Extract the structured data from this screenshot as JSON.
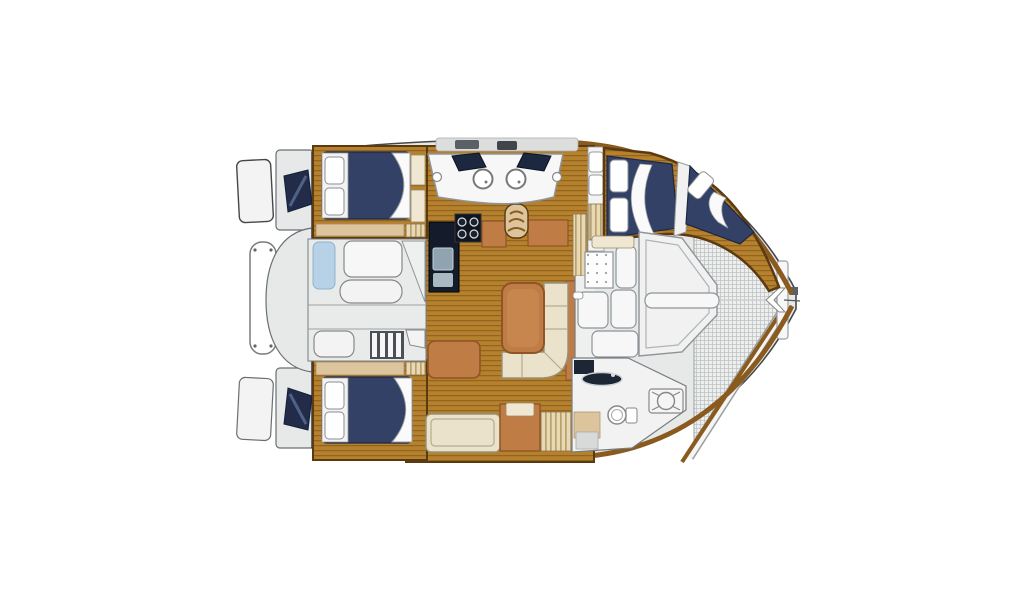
{
  "title": "catamaran-interior-floor-plan",
  "canvas": {
    "width": 1024,
    "height": 600,
    "background": "#ffffff"
  },
  "palette": {
    "hull_fill": "#e7e9e8",
    "hull_stroke": "#43484c",
    "deck_white": "#f2f3f2",
    "panel_white": "#f6f7f6",
    "teak": "#b5812c",
    "teak_grain": "#8a5d1e",
    "wood_trim": "#5b3a10",
    "wood_mid": "#8a5a1e",
    "furniture": "#bf7c45",
    "furniture_dark": "#8f5526",
    "berth_navy": "#334167",
    "berth_navy_dark": "#222c49",
    "pillow_white": "#ffffff",
    "cushion_cream": "#ebe2cc",
    "cushion_edge": "#b6ab8e",
    "pad_blue": "#b7d2e6",
    "counter_black": "#141c2b",
    "tan_shelf": "#dcc49c",
    "stripe_tan": "#e8d9b4",
    "stripe_line": "#a58a55",
    "mesh_bg": "#edefee",
    "mesh_line": "#b7bbbb",
    "steel_gray": "#596066"
  },
  "regions": [
    {
      "id": "hull-silhouette",
      "kind": "catamaran-deck-plan"
    },
    {
      "id": "swim-platform-port",
      "kind": "swim-platform"
    },
    {
      "id": "swim-platform-starboard",
      "kind": "swim-platform"
    },
    {
      "id": "transom-steps-port",
      "kind": "transom-steps"
    },
    {
      "id": "transom-steps-starboard",
      "kind": "transom-steps"
    },
    {
      "id": "stern-rail",
      "kind": "railing"
    },
    {
      "id": "aft-cockpit",
      "kind": "cockpit-seating"
    },
    {
      "id": "port-aft-cabin",
      "kind": "double-berth-cabin"
    },
    {
      "id": "starboard-aft-cabin",
      "kind": "double-berth-cabin"
    },
    {
      "id": "saloon-floor",
      "kind": "teak-sole"
    },
    {
      "id": "galley-counter",
      "kind": "galley-counter-with-stove"
    },
    {
      "id": "galley-island",
      "kind": "island-with-twin-sinks"
    },
    {
      "id": "companionway-steps",
      "kind": "steps"
    },
    {
      "id": "saloon-table",
      "kind": "table"
    },
    {
      "id": "saloon-sofa",
      "kind": "l-shaped-settee"
    },
    {
      "id": "saloon-chaise",
      "kind": "bench"
    },
    {
      "id": "aft-settee",
      "kind": "settee"
    },
    {
      "id": "forward-cabin-berths",
      "kind": "v-berths"
    },
    {
      "id": "forward-cockpit",
      "kind": "foredeck-lounge"
    },
    {
      "id": "forward-head",
      "kind": "bathroom-toilet-sink-hatch"
    },
    {
      "id": "bow-trampoline",
      "kind": "mesh-trampoline"
    },
    {
      "id": "bow-crossbeam",
      "kind": "crossbeam"
    },
    {
      "id": "coachroof-hatches",
      "kind": "roof-hatches"
    }
  ]
}
